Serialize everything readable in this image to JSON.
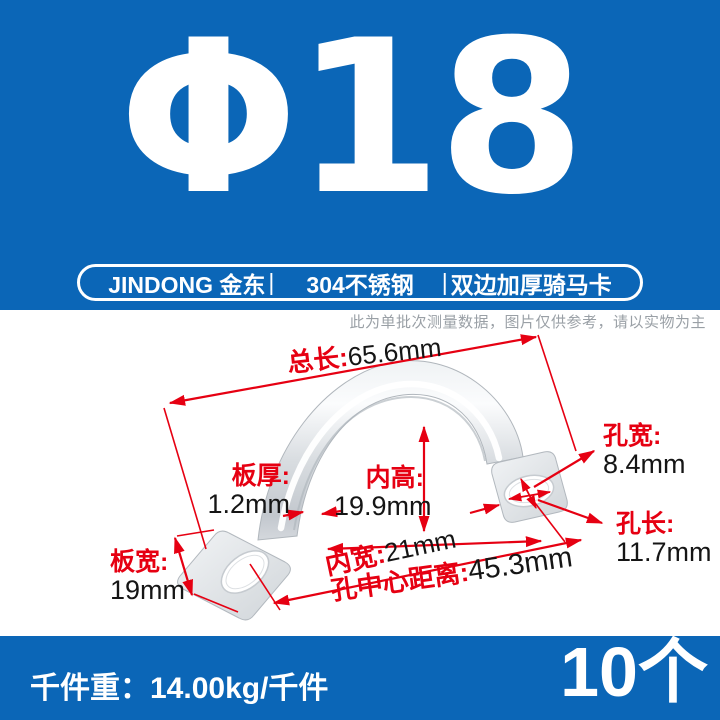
{
  "colors": {
    "banner_blue": "#0b66b7",
    "annotation_red": "#e60012",
    "value_text": "#151515",
    "disclaimer_gray": "#9aa0a6",
    "metal_light": "#fbfcfd",
    "metal_dark": "#c3c8ce"
  },
  "header": {
    "diameter": "Φ18",
    "brand": "JINDONG 金东",
    "sep1": "|",
    "material": "304不锈钢",
    "sep2": "|",
    "product": "双边加厚骑马卡"
  },
  "disclaimer": "此为单批次测量数据，图片仅供参考，请以实物为主",
  "dims": {
    "total_length": {
      "label": "总长:",
      "value": "65.6mm"
    },
    "plate_thickness": {
      "label": "板厚:",
      "value": "1.2mm"
    },
    "inner_height": {
      "label": "内高:",
      "value": "19.9mm"
    },
    "inner_width": {
      "label": "内宽:",
      "value": "21mm"
    },
    "hole_width": {
      "label": "孔宽:",
      "value": "8.4mm"
    },
    "hole_length": {
      "label": "孔长:",
      "value": "11.7mm"
    },
    "plate_width": {
      "label": "板宽:",
      "value": "19mm"
    },
    "hole_center_distance": {
      "label": "孔中心距离:",
      "value": "45.3mm"
    }
  },
  "footer": {
    "weight_label": "千件重：",
    "weight_value": "14.00kg/千件",
    "quantity": "10个"
  }
}
